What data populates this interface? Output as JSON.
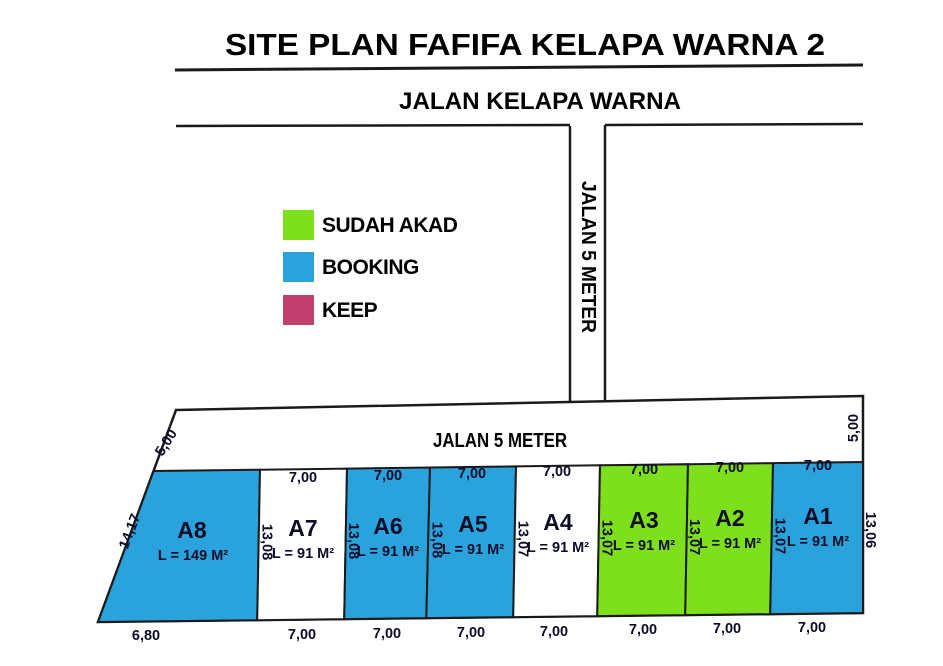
{
  "header": {
    "title": "SITE PLAN FAFIFA KELAPA WARNA 2",
    "main_road_label": "JALAN KELAPA WARNA"
  },
  "roads": {
    "vertical_road_label": "JALAN 5 METER",
    "inner_road_label": "JALAN 5 METER",
    "inner_road_width_left": "5,00",
    "inner_road_width_right": "5,00"
  },
  "legend": {
    "items": [
      {
        "label": "SUDAH AKAD",
        "color": "#7EE01C",
        "status": "sudah_akad"
      },
      {
        "label": "BOOKING",
        "color": "#2AA3DD",
        "status": "booking"
      },
      {
        "label": "KEEP",
        "color": "#C2406E",
        "status": "keep"
      }
    ]
  },
  "site": {
    "right_boundary_dim": "13,06",
    "plots": [
      {
        "id": "A8",
        "area": "L = 149 M²",
        "status": "booking",
        "fill": "#2AA3DD",
        "side": "14,17",
        "bottom": "6,80"
      },
      {
        "id": "A7",
        "area": "L = 91 M²",
        "status": "available",
        "fill": "#FFFFFF",
        "top": "7,00",
        "side": "13,08",
        "bottom": "7,00"
      },
      {
        "id": "A6",
        "area": "L = 91 M²",
        "status": "booking",
        "fill": "#2AA3DD",
        "top": "7,00",
        "side": "13,08",
        "bottom": "7,00"
      },
      {
        "id": "A5",
        "area": "L = 91 M²",
        "status": "booking",
        "fill": "#2AA3DD",
        "top": "7,00",
        "side": "13,08",
        "bottom": "7,00"
      },
      {
        "id": "A4",
        "area": "L = 91 M²",
        "status": "available",
        "fill": "#FFFFFF",
        "top": "7,00",
        "side": "13,07",
        "bottom": "7,00"
      },
      {
        "id": "A3",
        "area": "L = 91 M²",
        "status": "sudah_akad",
        "fill": "#7EE01C",
        "top": "7,00",
        "side": "13,07",
        "bottom": "7,00"
      },
      {
        "id": "A2",
        "area": "L = 91 M²",
        "status": "sudah_akad",
        "fill": "#7EE01C",
        "top": "7,00",
        "side": "13,07",
        "bottom": "7,00"
      },
      {
        "id": "A1",
        "area": "L = 91 M²",
        "status": "booking",
        "fill": "#2AA3DD",
        "top": "7,00",
        "side": "13,07",
        "bottom": "7,00"
      }
    ]
  },
  "colors": {
    "outline": "#1A1A1A",
    "label_text": "#0D0D28",
    "road_text": "#000000"
  }
}
